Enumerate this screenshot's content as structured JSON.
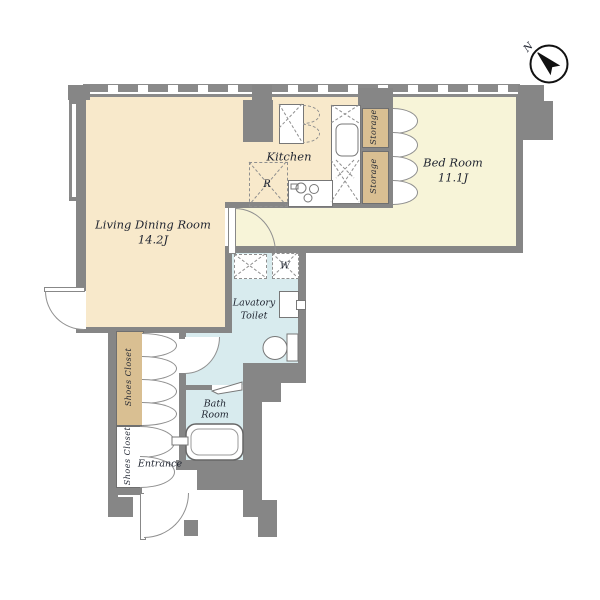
{
  "plan_title": "apartment-floor-plan",
  "compass": {
    "north_label": "N"
  },
  "rooms": {
    "living_dining": {
      "name": "Living Dining Room",
      "size": "14.2J"
    },
    "kitchen": {
      "name": "Kitchen"
    },
    "bedroom": {
      "name": "Bed Room",
      "size": "11.1J"
    },
    "storage_top": {
      "name": "Storage"
    },
    "storage_bottom": {
      "name": "Storage"
    },
    "lavatory": {
      "line1": "Lavatory",
      "line2": "Toilet"
    },
    "bathroom": {
      "line1": "Bath",
      "line2": "Room"
    },
    "entrance": {
      "name": "Entrance"
    },
    "shoes_closet_upper": {
      "name": "Shoes Closet"
    },
    "shoes_closet_lower": {
      "name": "Shoes Closet"
    }
  },
  "fixtures": {
    "washing_machine": "W",
    "refrigerator": "R"
  },
  "colors": {
    "wall": "#868686",
    "living_kitchen_floor": "#f8e9cb",
    "bedroom_floor": "#f7f4d8",
    "closet_fill": "#d9bf92",
    "wet_area_floor": "#d8ebee",
    "outline": "#8f8f8f",
    "text": "#1f2430"
  }
}
